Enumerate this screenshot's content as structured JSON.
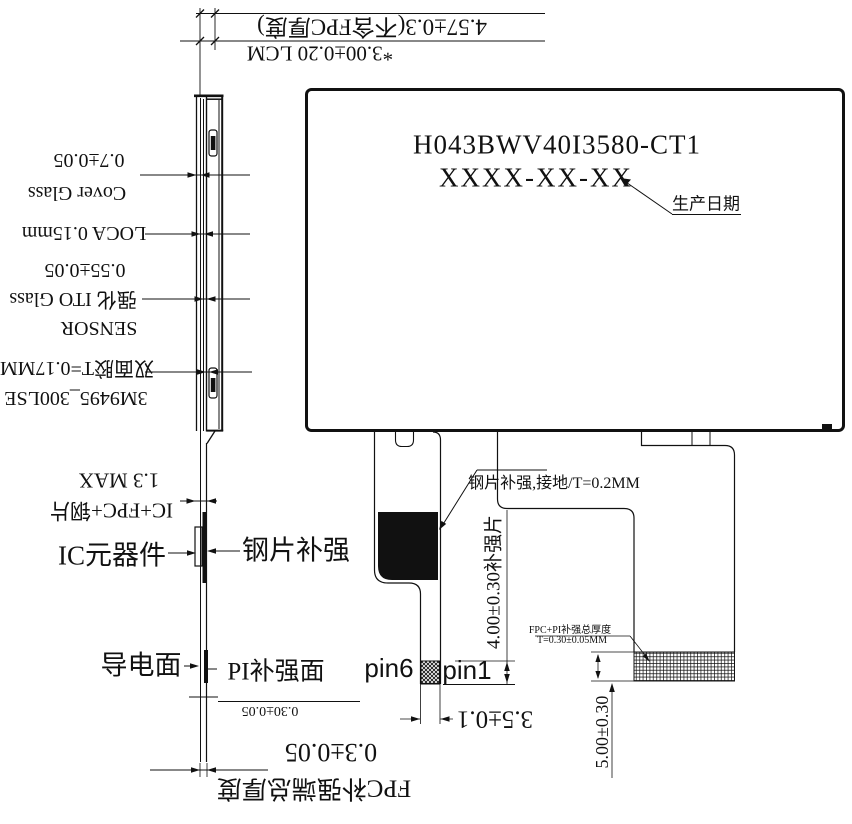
{
  "top": {
    "total": "4.57±0.3(不含FPC厚度)",
    "lcm": "*3.00±0.20 LCM"
  },
  "stack": {
    "cover_thickness": "0.7±0.05",
    "cover_name": "Cover Glass",
    "loca": "LOCA 0.15mm",
    "sensor_thickness": "0.55±0.05",
    "sensor_glass": "强化 ITO Glass",
    "sensor_name": "SENSOR",
    "tape": "双面胶T=0.17MM",
    "tape_model": "3M9495_300LSE"
  },
  "ic": {
    "max": "1.3 MAX",
    "stackup": "IC+FPC+钢片",
    "component": "IC元器件",
    "steel": "钢片补强"
  },
  "end": {
    "conductive": "导电面",
    "pi_face": "PI补强面",
    "pi_dim": "0.30±0.05",
    "total_dim": "0.3±0.05",
    "total_label": "FPC补强端总厚度"
  },
  "panel": {
    "model": "H043BWV40I3580-CT1",
    "date_code": "XXXX-XX-XX",
    "date_label": "生产日期"
  },
  "fpc": {
    "steel_note": "钢片补强,接地/T=0.2MM",
    "stiffener_dim": "4.00±0.30补强片",
    "pin6": "pin6",
    "pin1": "pin1",
    "pin_width": "3.5±0.1",
    "pi_note1": "FPC+PI补强总厚度",
    "pi_note2": "T=0.30±0.05MM",
    "tail_dim": "5.00±0.30"
  },
  "colors": {
    "ink": "#111111",
    "background": "#ffffff"
  }
}
